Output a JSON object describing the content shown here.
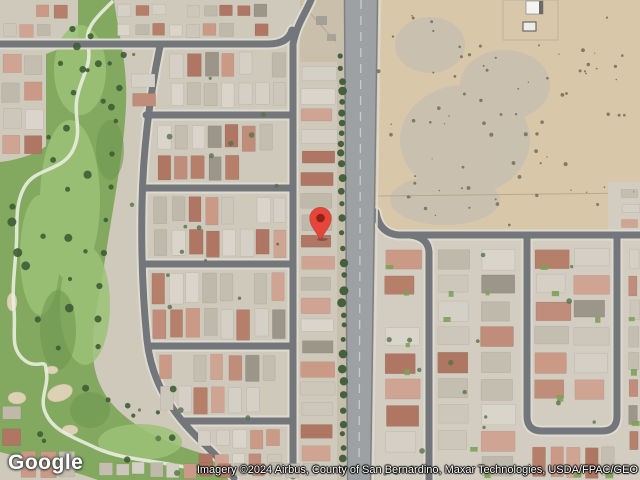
{
  "map": {
    "description": "Satellite view of a residential neighborhood with golf course, north-south arterial road, and vacant desert lot",
    "logo_text": "Google",
    "attribution": "Imagery ©2024 Airbus, County of San Bernardino, Maxar Technologies, USDA/FPAC/GEO",
    "marker": {
      "x": 320,
      "y": 240
    },
    "features": [
      "golf-course",
      "residential-neighborhood-west",
      "main-road",
      "vacant-desert-lot",
      "residential-neighborhood-east",
      "white-building",
      "location-marker"
    ],
    "colors": {
      "marker_red": "#E8453A",
      "marker_inner_red": "#8E2418",
      "desert_sand": "#D8C7A9",
      "desert_patch_gray": "#BDBCB6",
      "ground_west": "#CFC9BC",
      "ground_east": "#D3CDC1",
      "street_asphalt": "#73777B",
      "street_sidewalk": "#DEDACF",
      "main_road": "#9EA1A3",
      "road_center_line": "#C9CBCB",
      "golf_green": "#82A95F",
      "golf_light": "#9CC277",
      "golf_dark": "#6E9750",
      "cart_path": "#E9EDE0",
      "bunker_sand": "#DDD1B5",
      "tree_dark": "#3E5C36",
      "shrub_olive": "#716F52",
      "lawn_green": "#7DA257",
      "building_white": "#F4F4F2",
      "roof_grays": [
        "#CDC7BB",
        "#D5D0C6",
        "#C4BEB1",
        "#D9D5CB",
        "#BFB9AC"
      ],
      "roof_reds": [
        "#C08D7A",
        "#B57F6A",
        "#CA9A87",
        "#AE7663",
        "#D0A493"
      ],
      "roof_dark": "#9B958A"
    }
  }
}
